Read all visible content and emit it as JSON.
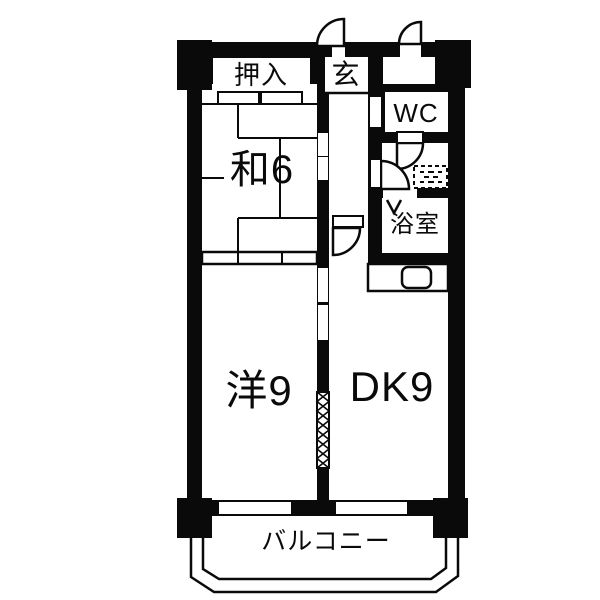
{
  "plan": {
    "type": "apartment-floorplan",
    "colors": {
      "wall": "#0a0a0a",
      "floor": "#ffffff"
    },
    "rooms": {
      "oshiire": {
        "label": "押入"
      },
      "genkan": {
        "label": "玄"
      },
      "wc": {
        "label": "WC"
      },
      "washitsu": {
        "label": "和6"
      },
      "bathroom": {
        "label": "浴室"
      },
      "western_room": {
        "label": "洋9"
      },
      "dining_kitchen": {
        "label": "DK9"
      },
      "balcony": {
        "label": "バルコニー"
      }
    },
    "icons": {
      "door_swing": "quarter-circle door swing symbol",
      "folding_door": "V folding-door symbol",
      "washing_machine": "dashed washing-machine pan",
      "sink": "rounded kitchen sink",
      "accordion_door": "zigzag accordion partition",
      "railing": "balcony railing double line"
    }
  }
}
